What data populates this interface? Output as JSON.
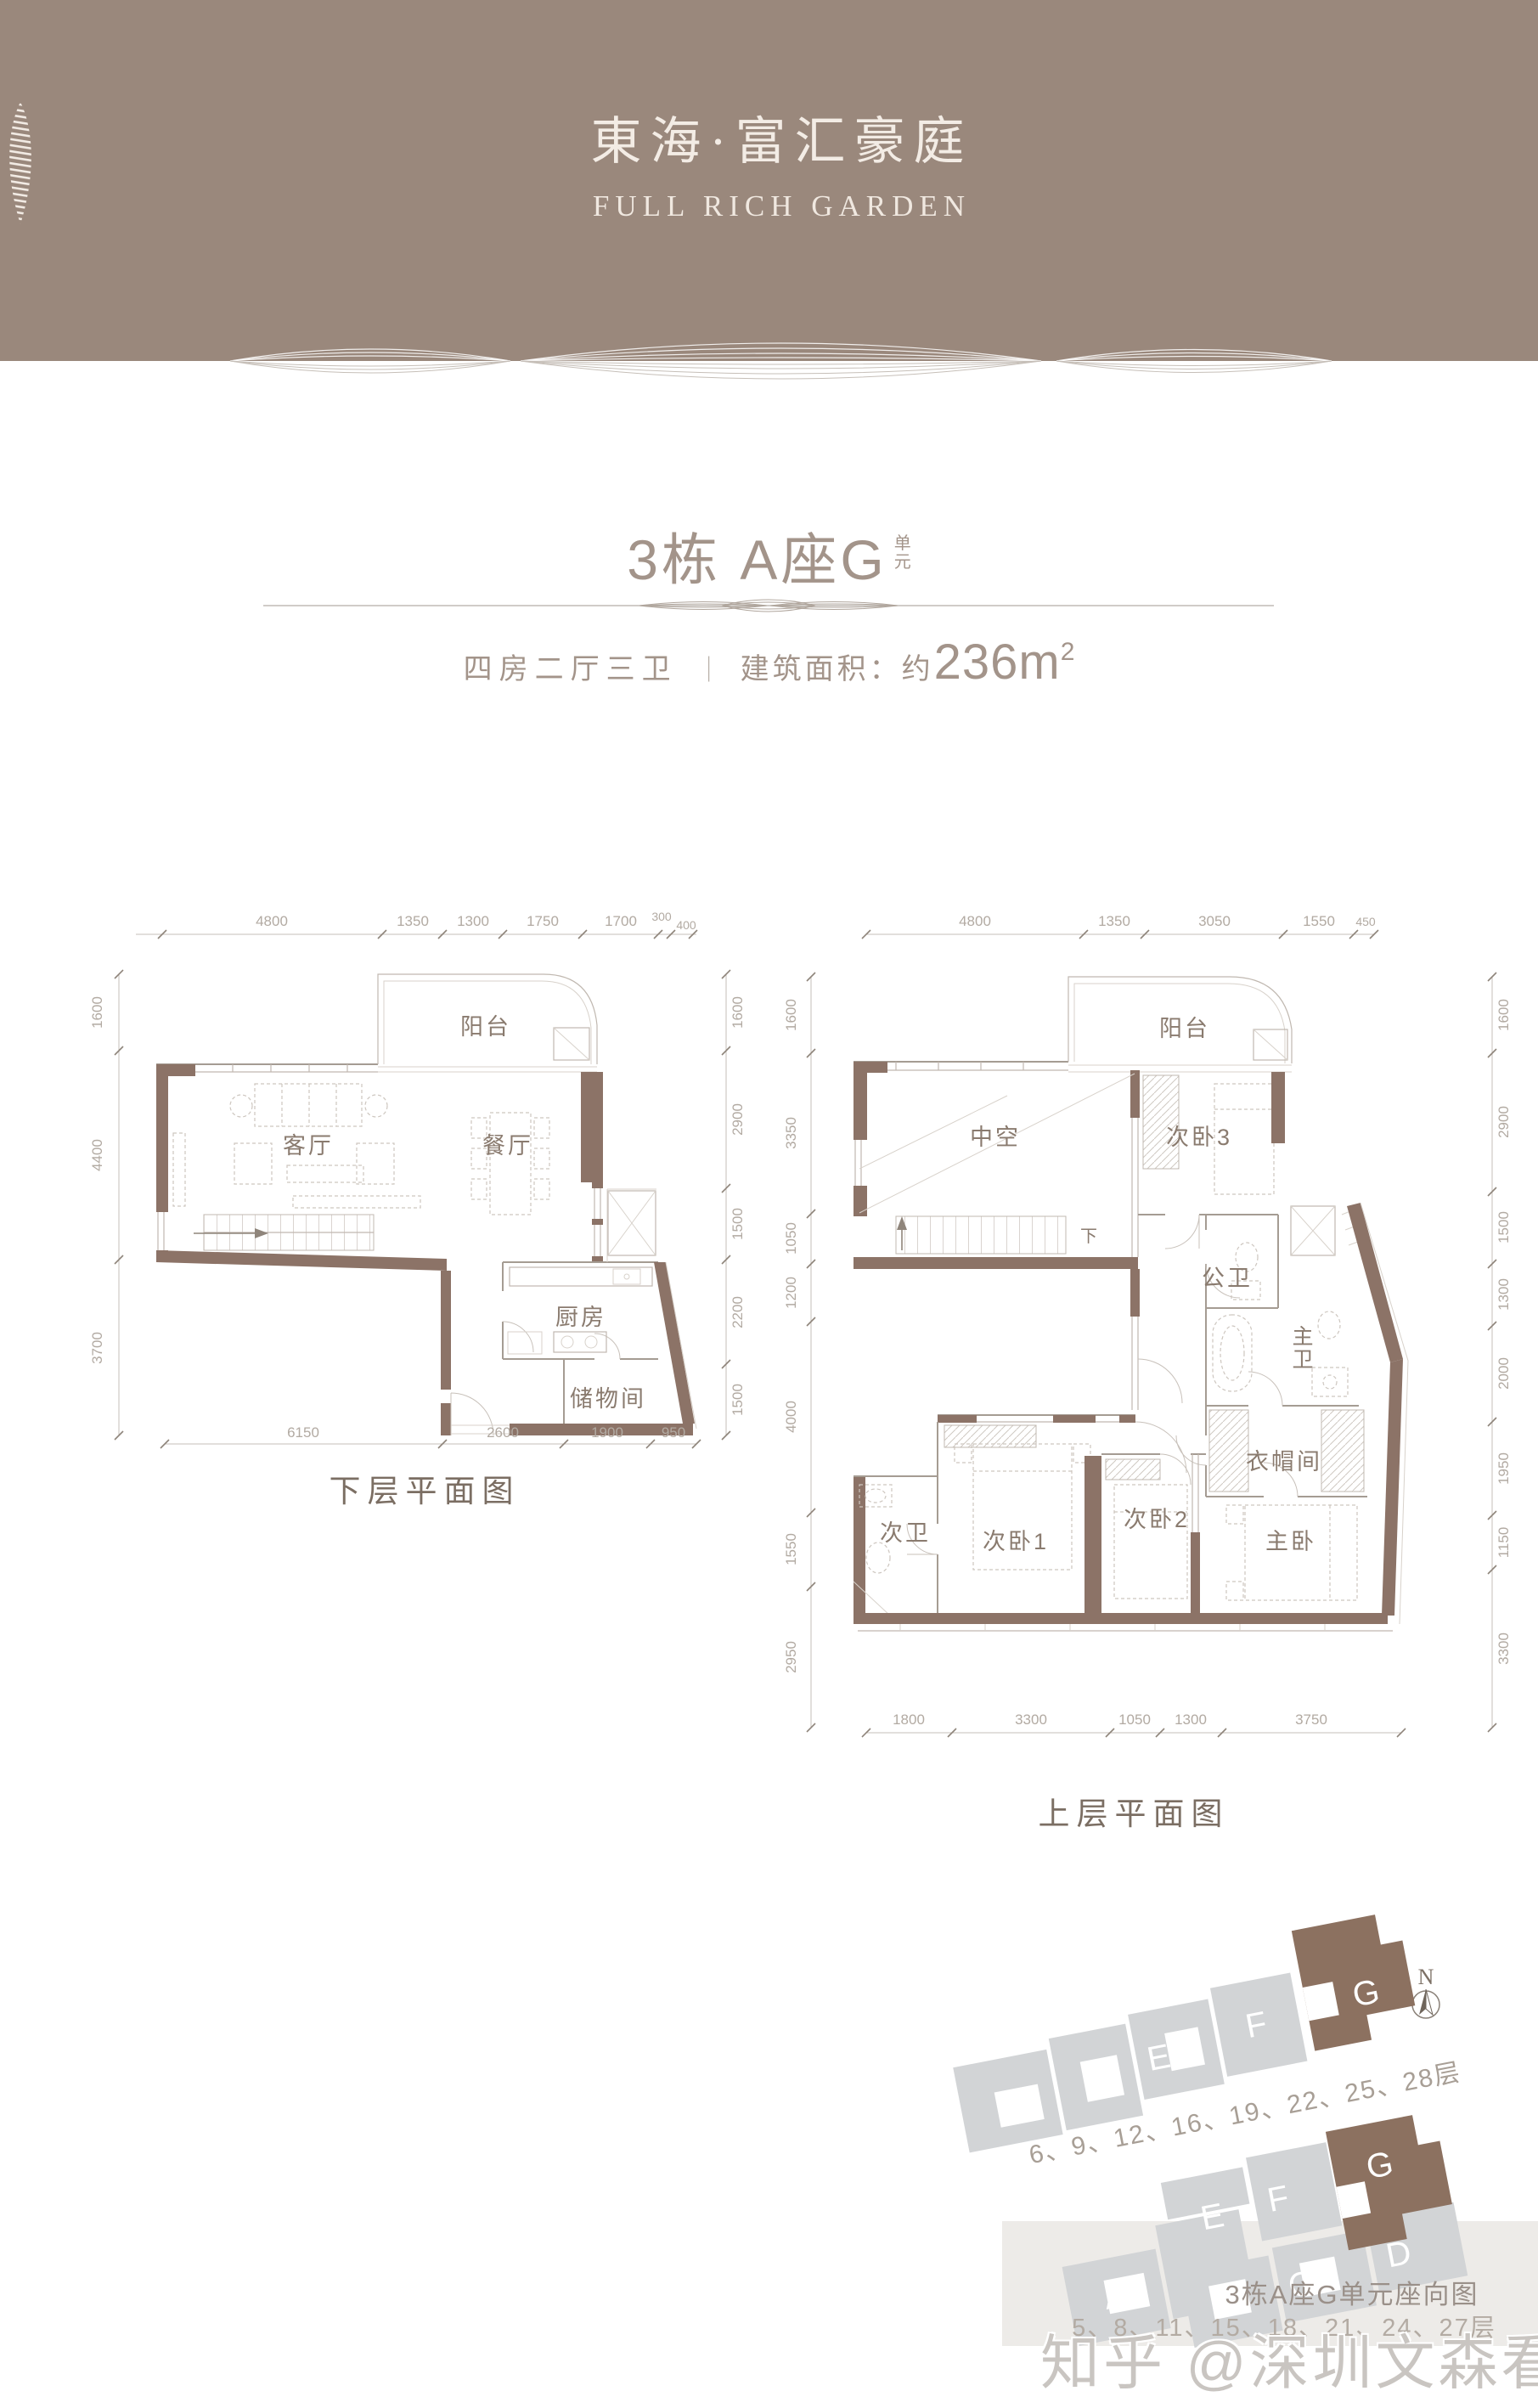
{
  "header": {
    "brand_cn": "東海·富汇豪庭",
    "brand_en": "FULL RICH GARDEN"
  },
  "unit": {
    "title": "3栋 A座G",
    "suffix_top": "单",
    "suffix_bottom": "元",
    "spec": "四房二厅三卫",
    "sep": "｜",
    "area_label": "建筑面积：约",
    "area_value": "236m",
    "area_sup": "2"
  },
  "plans": {
    "lower": {
      "caption": "下层平面图",
      "rooms": {
        "balcony": "阳台",
        "living": "客厅",
        "dining": "餐厅",
        "kitchen": "厨房",
        "storage": "储物间"
      },
      "dims_top": [
        "4800",
        "1350",
        "1300",
        "1750",
        "1700",
        "300",
        "400"
      ],
      "dims_left": [
        "1600",
        "4400",
        "3700"
      ],
      "dims_right": [
        "1600",
        "2900",
        "1500",
        "2200",
        "1500"
      ],
      "dims_bottom": [
        "6150",
        "2600",
        "1900",
        "950"
      ]
    },
    "upper": {
      "caption": "上层平面图",
      "stair_label": "下",
      "rooms": {
        "balcony": "阳台",
        "void": "中空",
        "bed3": "次卧3",
        "bath_public": "公卫",
        "bath_master": "主卫",
        "closet": "衣帽间",
        "bath2": "次卫",
        "bed1": "次卧1",
        "bed2": "次卧2",
        "master": "主卧"
      },
      "dims_top": [
        "4800",
        "1350",
        "3050",
        "1550",
        "450"
      ],
      "dims_left": [
        "1600",
        "3350",
        "1050",
        "1200",
        "4000",
        "1550",
        "2950"
      ],
      "dims_right": [
        "1600",
        "2900",
        "1500",
        "1300",
        "2000",
        "1950",
        "1150",
        "3300"
      ],
      "dims_bottom": [
        "1800",
        "3300",
        "1050",
        "1300",
        "3750"
      ]
    }
  },
  "site": {
    "north": "N",
    "cluster_a": {
      "letters": [
        "A",
        "E",
        "F",
        "G"
      ],
      "floors": "6、9、12、16、19、22、25、28层"
    },
    "cluster_b": {
      "letters": [
        "A",
        "B",
        "C",
        "D",
        "E",
        "F",
        "G"
      ],
      "floors": "5、8、11、15、18、21、24、27层"
    },
    "caption": "3栋A座G单元座向图"
  },
  "watermark": "知乎 @深圳文森看房",
  "colors": {
    "header_bg": "#9a887c",
    "header_text": "#f3ece5",
    "wall_accent": "#8c7367",
    "line_gray": "#a59c93",
    "dim_text": "#b2aaa2",
    "room_text": "#8a7b6f",
    "site_building": "#d2d4d6",
    "site_highlight": "#8c7160",
    "watermark_text": "#c9c5c1",
    "band_bg": "#edebe8"
  }
}
